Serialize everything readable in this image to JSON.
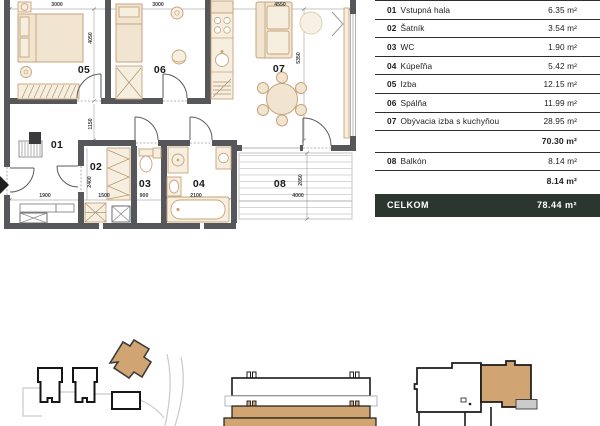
{
  "legend": {
    "rows": [
      {
        "num": "01",
        "name": "Vstupná hala",
        "area": "6.35 m²"
      },
      {
        "num": "02",
        "name": "Šatník",
        "area": "3.54 m²"
      },
      {
        "num": "03",
        "name": "WC",
        "area": "1.90 m²"
      },
      {
        "num": "04",
        "name": "Kúpeľňa",
        "area": "5.42 m²"
      },
      {
        "num": "05",
        "name": "Izba",
        "area": "12.15 m²"
      },
      {
        "num": "06",
        "name": "Spálňa",
        "area": "11.99 m²"
      },
      {
        "num": "07",
        "name": "Obývacia izba s kuchyňou",
        "area": "28.95 m²"
      }
    ],
    "interior_subtotal": "70.30 m²",
    "balcony_row": {
      "num": "08",
      "name": "Balkón",
      "area": "8.14 m²"
    },
    "balcony_subtotal": "8.14 m²",
    "total": {
      "label": "CELKOM",
      "area": "78.44 m²"
    }
  },
  "plan": {
    "room_labels": {
      "r1": "01",
      "r2": "02",
      "r3": "03",
      "r4": "04",
      "r5": "05",
      "r6": "06",
      "r7": "07",
      "r8": "08"
    },
    "dimensions": {
      "top_left": "3000",
      "top_mid": "3000",
      "top_right": "4550",
      "bedroom_v": "4050",
      "living_v": "5350",
      "hall_v": "1150",
      "closet_v": "2400",
      "entry_w": "1900",
      "closet_w": "1500",
      "wc_w": "900",
      "bath_w": "2100",
      "balcony_w": "4000",
      "balcony_v": "2050"
    }
  },
  "colors": {
    "wall": "#56575B",
    "furniture": "#F1E5D1",
    "accent": "#D0A571",
    "total_bar_bg": "#2B362F"
  }
}
